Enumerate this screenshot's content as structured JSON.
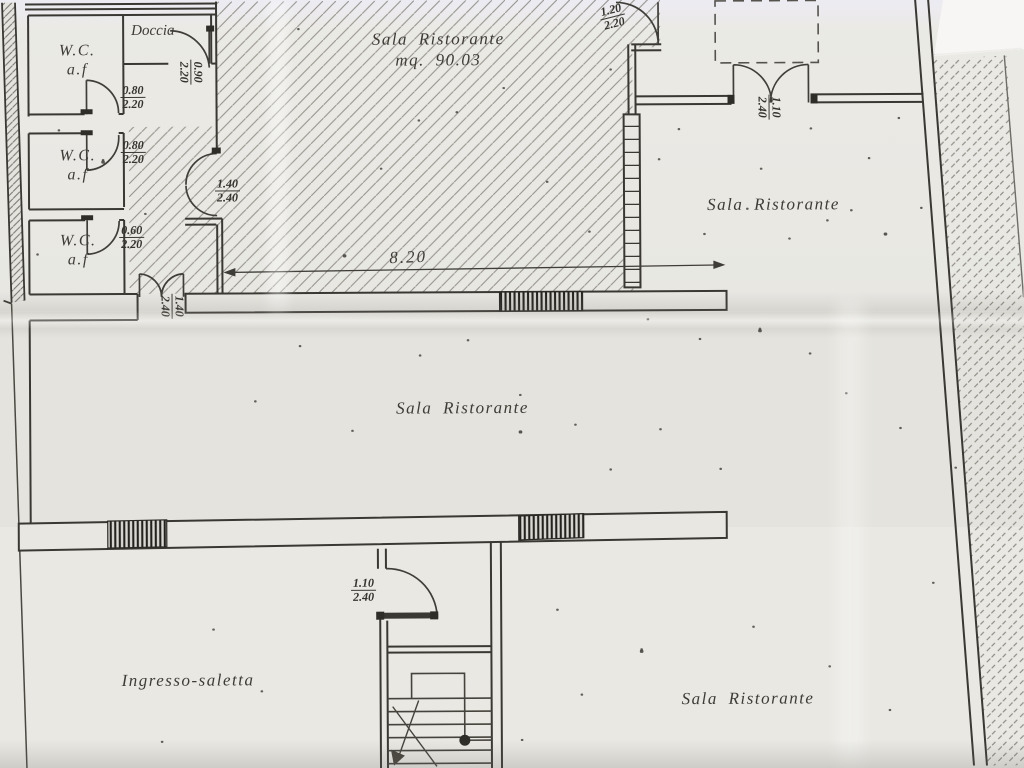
{
  "rooms": {
    "wc1": {
      "label": "W.C.",
      "sub": "a.f"
    },
    "wc2": {
      "label": "W.C.",
      "sub": "a.f"
    },
    "wc3": {
      "label": "W.C.",
      "sub": "a.f"
    },
    "doccia": {
      "label": "Doccia"
    },
    "sala_main": {
      "label": "Sala Ristorante",
      "area": "mq. 90.03"
    },
    "sala_right": {
      "label": "Sala Ristorante"
    },
    "sala_middle": {
      "label": "Sala Ristorante"
    },
    "sala_bottom": {
      "label": "Sala Ristorante"
    },
    "ingresso": {
      "label": "Ingresso-saletta"
    }
  },
  "dims": {
    "wc1": {
      "w": "0.80",
      "h": "2.20"
    },
    "wc2": {
      "w": "0.80",
      "h": "2.20"
    },
    "wc3": {
      "w": "0.60",
      "h": "2.20"
    },
    "doccia": {
      "w": "0.90",
      "h": "2.20"
    },
    "corridor_door": {
      "w": "1.40",
      "h": "2.40"
    },
    "middle_door": {
      "w": "1.40",
      "h": "2.40"
    },
    "top_door": {
      "w": "1.20",
      "h": "2.20"
    },
    "right_door": {
      "w": "1.10",
      "h": "2.40"
    },
    "stair_door": {
      "w": "1.10",
      "h": "2.40"
    },
    "total_width": {
      "value": "8.20"
    }
  },
  "colors": {
    "ink": "#3a3833",
    "paper": "#e8e7e2",
    "hatch": "#96948c"
  }
}
